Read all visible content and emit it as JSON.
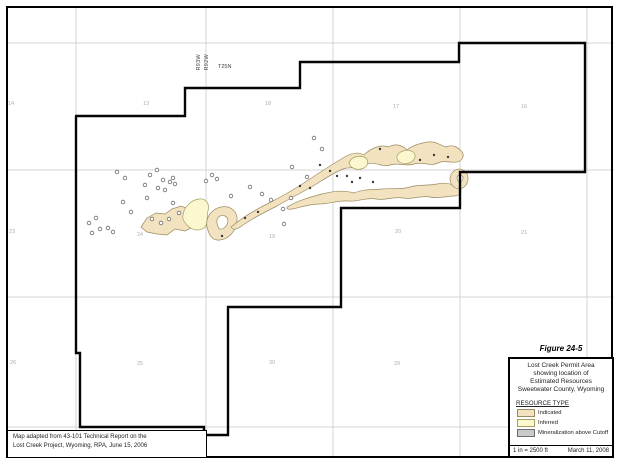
{
  "figure": {
    "label": "Figure 24-5",
    "title_lines": [
      "Lost Creek Permit Area",
      "showing location of",
      "Estimated Resources",
      "Sweetwater County, Wyoming"
    ],
    "scale": "1 in = 2500 ft",
    "date": "March 11, 2008",
    "legend": {
      "heading": "RESOURCE TYPE",
      "items": [
        {
          "label": "Indicated",
          "color": "#F2E2C0",
          "border": "#9A8B62"
        },
        {
          "label": "Inferred",
          "color": "#FBF8D0",
          "border": "#A3A060"
        },
        {
          "label": "Mineralization above Cutoff",
          "color": "#C9C9C9",
          "border": "#6E6E6E"
        }
      ]
    }
  },
  "note": {
    "lines": [
      "Map adapted from 43-101 Technical Report on the",
      "Lost Creek Project, Wyoming, RPA, June 15, 2006"
    ]
  },
  "labels": {
    "range_west": "R93W",
    "range_east": "R92W",
    "township": "T25N"
  },
  "map": {
    "grid": {
      "vertical_x": [
        76,
        206,
        333,
        460,
        587
      ],
      "horizontal_y": [
        43,
        170,
        297,
        427
      ],
      "color": "#C9C9C9"
    },
    "section_numbers": [
      {
        "n": "14",
        "x": 11,
        "y": 105
      },
      {
        "n": "13",
        "x": 146,
        "y": 105
      },
      {
        "n": "18",
        "x": 268,
        "y": 105
      },
      {
        "n": "17",
        "x": 396,
        "y": 108
      },
      {
        "n": "16",
        "x": 524,
        "y": 108
      },
      {
        "n": "23",
        "x": 12,
        "y": 233
      },
      {
        "n": "24",
        "x": 140,
        "y": 236
      },
      {
        "n": "19",
        "x": 272,
        "y": 238
      },
      {
        "n": "20",
        "x": 398,
        "y": 233
      },
      {
        "n": "21",
        "x": 524,
        "y": 234
      },
      {
        "n": "26",
        "x": 13,
        "y": 364
      },
      {
        "n": "25",
        "x": 140,
        "y": 365
      },
      {
        "n": "30",
        "x": 272,
        "y": 364
      },
      {
        "n": "29",
        "x": 397,
        "y": 365
      }
    ],
    "permit_boundary": {
      "color": "#050505",
      "points": [
        [
          75,
          116
        ],
        [
          185,
          116
        ],
        [
          185,
          88
        ],
        [
          300,
          88
        ],
        [
          300,
          62
        ],
        [
          459,
          62
        ],
        [
          459,
          43
        ],
        [
          585,
          43
        ],
        [
          585,
          172
        ],
        [
          460,
          172
        ],
        [
          460,
          208
        ],
        [
          341,
          208
        ],
        [
          341,
          307
        ],
        [
          228,
          307
        ],
        [
          228,
          435
        ],
        [
          204,
          435
        ],
        [
          204,
          427
        ],
        [
          80,
          427
        ],
        [
          80,
          353
        ],
        [
          76,
          353
        ],
        [
          76,
          116
        ]
      ]
    },
    "ore_bodies": [
      {
        "type": "indicated",
        "name": "west-blob",
        "path": "M141,227 L147,218 L156,213 L165,214 L172,209 L181,206 L189,209 L193,215 L188,221 L193,227 L185,231 L175,229 L167,235 L157,234 L147,232 Z"
      },
      {
        "type": "inferred",
        "name": "west-inferred-patch",
        "path": "M183,215 C184,207 191,200 199,199 C206,198 210,204 208,211 C206,217 209,222 205,227 C200,232 192,230 188,226 C184,222 182,219 183,215 Z"
      },
      {
        "type": "indicated",
        "name": "hook-loop",
        "path": "M207,227 C205,217 212,209 221,207 C231,205 238,212 237,221 C236,231 229,239 220,240 C212,241 209,235 207,227 Z M217,223 C216,218 220,214 225,216 C229,218 229,224 224,228 C219,231 218,228 217,223 Z"
      },
      {
        "type": "indicated",
        "name": "main-trend-north",
        "path": "M231,227 C243,217 255,210 267,204 C281,197 295,189 307,181 C319,173 331,165 343,158 C349,154 357,151 364,155 C371,148 381,144 389,147 C395,143 402,145 407,150 C413,145 421,143 428,142 C435,141 440,145 446,147 C452,144 458,147 462,152 C465,156 462,161 457,162 C450,163 444,160 438,163 C430,167 422,161 414,164 C406,167 398,162 390,165 C382,168 374,160 366,165 C358,170 350,166 343,169 C333,173 323,180 313,186 C301,193 289,199 277,206 C265,212 253,218 243,225 C238,229 233,231 231,227 Z"
      },
      {
        "type": "indicated",
        "name": "main-trend-south",
        "path": "M289,206 C299,200 311,197 322,194 C333,191 344,190 354,193 C363,189 373,190 382,189 C392,188 401,190 410,187 C419,184 429,186 437,184 C445,182 453,184 459,188 C463,191 460,196 454,196 C446,196 438,199 430,197 C421,195 412,200 403,198 C394,196 385,201 376,199 C367,197 358,202 349,201 C339,200 329,204 319,204 C309,204 299,208 292,209 C287,210 285,208 289,206 Z"
      },
      {
        "type": "inferred",
        "name": "inferred-patch-mid",
        "path": "M349,163 C351,157 358,155 364,157 C369,159 369,165 364,168 C358,171 351,169 349,163 Z"
      },
      {
        "type": "inferred",
        "name": "inferred-sliver-east",
        "path": "M397,156 C400,150 408,149 413,152 C417,155 415,161 409,163 C403,165 396,162 397,156 Z"
      },
      {
        "type": "indicated",
        "name": "east-ring",
        "path": "M450,179 C450,172 457,167 463,170 C469,173 470,182 464,187 C458,192 450,186 450,179 Z M457,178 C457,175 461,174 463,177 C464,180 460,183 458,181 Z"
      }
    ],
    "drill_holes": [
      [
        117,
        172
      ],
      [
        125,
        178
      ],
      [
        145,
        185
      ],
      [
        150,
        175
      ],
      [
        157,
        170
      ],
      [
        158,
        188
      ],
      [
        163,
        180
      ],
      [
        170,
        182
      ],
      [
        173,
        178
      ],
      [
        175,
        184
      ],
      [
        165,
        190
      ],
      [
        147,
        198
      ],
      [
        123,
        202
      ],
      [
        173,
        203
      ],
      [
        131,
        212
      ],
      [
        96,
        218
      ],
      [
        89,
        223
      ],
      [
        100,
        229
      ],
      [
        108,
        228
      ],
      [
        113,
        232
      ],
      [
        92,
        233
      ],
      [
        152,
        219
      ],
      [
        161,
        223
      ],
      [
        169,
        219
      ],
      [
        179,
        213
      ],
      [
        206,
        181
      ],
      [
        212,
        175
      ],
      [
        217,
        179
      ],
      [
        231,
        196
      ],
      [
        250,
        187
      ],
      [
        262,
        194
      ],
      [
        271,
        200
      ],
      [
        283,
        209
      ],
      [
        284,
        224
      ],
      [
        291,
        198
      ],
      [
        292,
        167
      ],
      [
        307,
        177
      ],
      [
        314,
        138
      ],
      [
        322,
        149
      ]
    ],
    "intercept_dots": [
      [
        222,
        236
      ],
      [
        245,
        218
      ],
      [
        258,
        212
      ],
      [
        300,
        186
      ],
      [
        310,
        188
      ],
      [
        320,
        165
      ],
      [
        330,
        171
      ],
      [
        337,
        176
      ],
      [
        347,
        176
      ],
      [
        352,
        182
      ],
      [
        360,
        178
      ],
      [
        373,
        182
      ],
      [
        380,
        149
      ],
      [
        420,
        160
      ],
      [
        434,
        155
      ],
      [
        448,
        157
      ]
    ]
  }
}
